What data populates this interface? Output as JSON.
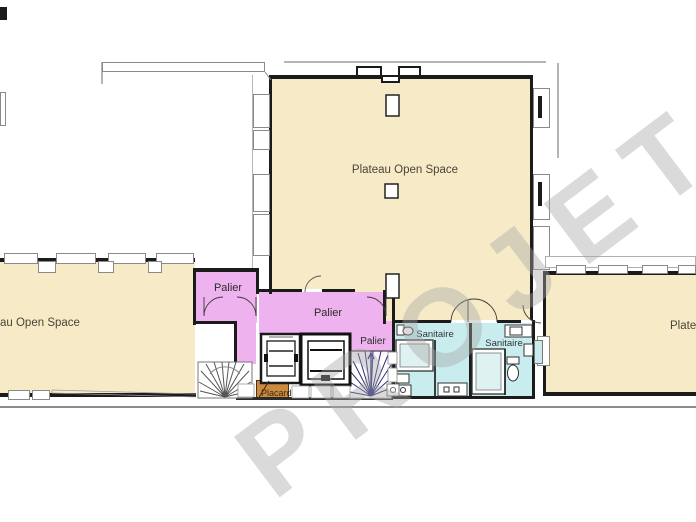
{
  "watermark": {
    "text": "PROJET"
  },
  "rooms": {
    "main": {
      "label": "Plateau Open Space",
      "fill": "#f6eac7"
    },
    "left": {
      "label": "au Open Space",
      "fill": "#f6eac7"
    },
    "right": {
      "label": "Plate",
      "fill": "#f6eac7"
    },
    "palier_left": {
      "label": "Palier",
      "fill": "#eeb3ee"
    },
    "palier_center": {
      "label": "Palier",
      "fill": "#eeb3ee"
    },
    "palier_small": {
      "label": "Palier",
      "fill": "#eeb3ee"
    },
    "sanitaire_left": {
      "label": "Sanitaire",
      "fill": "#c9edee"
    },
    "sanitaire_right": {
      "label": "Sanitaire",
      "fill": "#c9edee"
    },
    "placard": {
      "label": "Placard",
      "fill": "#cc8a41"
    }
  },
  "colors": {
    "wall": "#1b1b1b",
    "outline_gray": "#8a8a8a",
    "watermark_gray": "#d5d5d5",
    "stair_right_treads": "#2b2b7a",
    "open_space_fill": "#f6eac7",
    "palier_fill": "#eeb3ee",
    "sanitaire_fill": "#c9edee",
    "placard_fill": "#cc8a41"
  }
}
